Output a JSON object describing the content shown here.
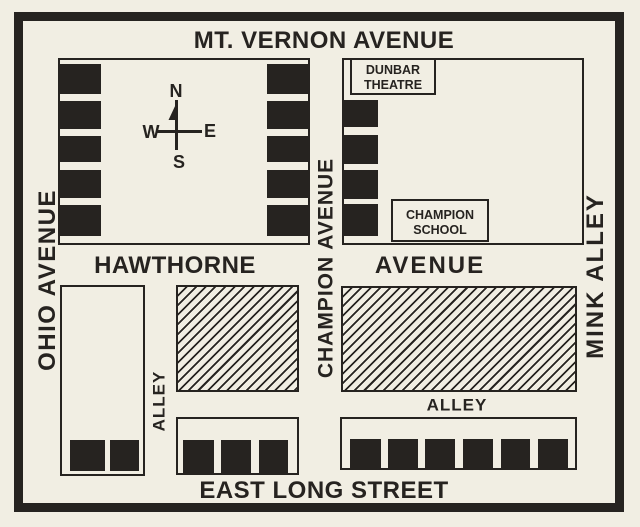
{
  "colors": {
    "paper": "#f1eee3",
    "ink": "#262320"
  },
  "streets": {
    "mt_vernon_avenue": "MT. VERNON AVENUE",
    "ohio_avenue": "OHIO AVENUE",
    "champion_avenue": "CHAMPION AVENUE",
    "mink_alley": "MINK ALLEY",
    "hawthorne": "HAWTHORNE",
    "avenue": "AVENUE",
    "alley_west": "ALLEY",
    "alley_east": "ALLEY",
    "east_long_street": "EAST LONG STREET"
  },
  "landmarks": {
    "dunbar_theatre": {
      "line1": "DUNBAR",
      "line2": "THEATRE"
    },
    "champion_school": {
      "line1": "CHAMPION",
      "line2": "SCHOOL"
    }
  },
  "compass": {
    "north": "N",
    "south": "S",
    "east": "E",
    "west": "W"
  }
}
